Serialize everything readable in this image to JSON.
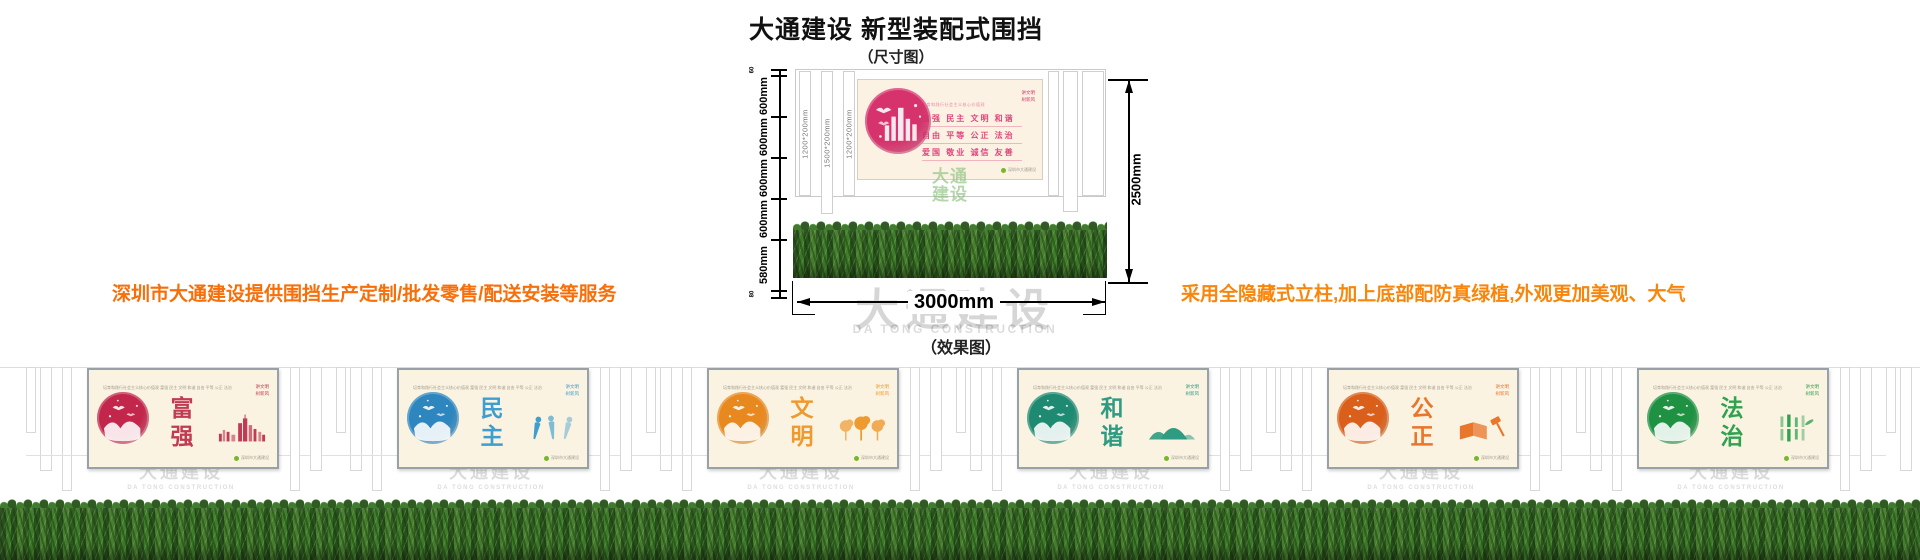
{
  "header": {
    "title": "大通建设 新型装配式围挡",
    "dim_caption": "（尺寸图）",
    "effect_caption": "（效果图）"
  },
  "promos": {
    "left": "深圳市大通建设提供围挡生产定制/批发零售/配送安装等服务",
    "right": "采用全隐藏式立柱,加上底部配防真绿植,外观更加美观、大气",
    "left_color": "#f86e08",
    "right_color": "#f9860a"
  },
  "dims": {
    "left_labels": [
      "60",
      "600mm",
      "600mm",
      "600mm",
      "600mm",
      "580mm",
      "80"
    ],
    "post_labels": [
      "1200*200mm",
      "1500*200mm",
      "1200*200mm"
    ],
    "height_label": "2500mm",
    "width_label": "3000mm"
  },
  "board_common": {
    "header_line": "培育和践行社会主义核心价值观",
    "corner_note": "讲文明\n树新风",
    "footer_note": "深圳市大通建设",
    "dot_color": "#76b82a"
  },
  "dim_board": {
    "rows": [
      "富强  民主  文明  和谐",
      "自由  平等  公正  法治",
      "爱国  敬业  诚信  友善"
    ],
    "accent": "#e0457b",
    "circle": "#d6336c"
  },
  "effect_header": "培育和践行社会主义核心价值观  富强 民主 文明 和谐 自由 平等 公正 法治 爱国 敬业 诚信 友善",
  "watermark": {
    "cn": "大通建设",
    "en": "DA TONG CONSTRUCTION"
  },
  "effect_panels": [
    {
      "word": "富强",
      "accent": "#c13b55",
      "circle": "#c2274b",
      "motif": "skyline"
    },
    {
      "word": "民主",
      "accent": "#3e9ecf",
      "circle": "#2e86bf",
      "motif": "people"
    },
    {
      "word": "文明",
      "accent": "#ef9a2f",
      "circle": "#e8891f",
      "motif": "trees"
    },
    {
      "word": "和谐",
      "accent": "#2e9b82",
      "circle": "#1f8a72",
      "motif": "mountains"
    },
    {
      "word": "公正",
      "accent": "#e8762b",
      "circle": "#d95f1b",
      "motif": "bookgavel"
    },
    {
      "word": "法治",
      "accent": "#2fa14f",
      "circle": "#1f9142",
      "motif": "bamboo"
    }
  ]
}
